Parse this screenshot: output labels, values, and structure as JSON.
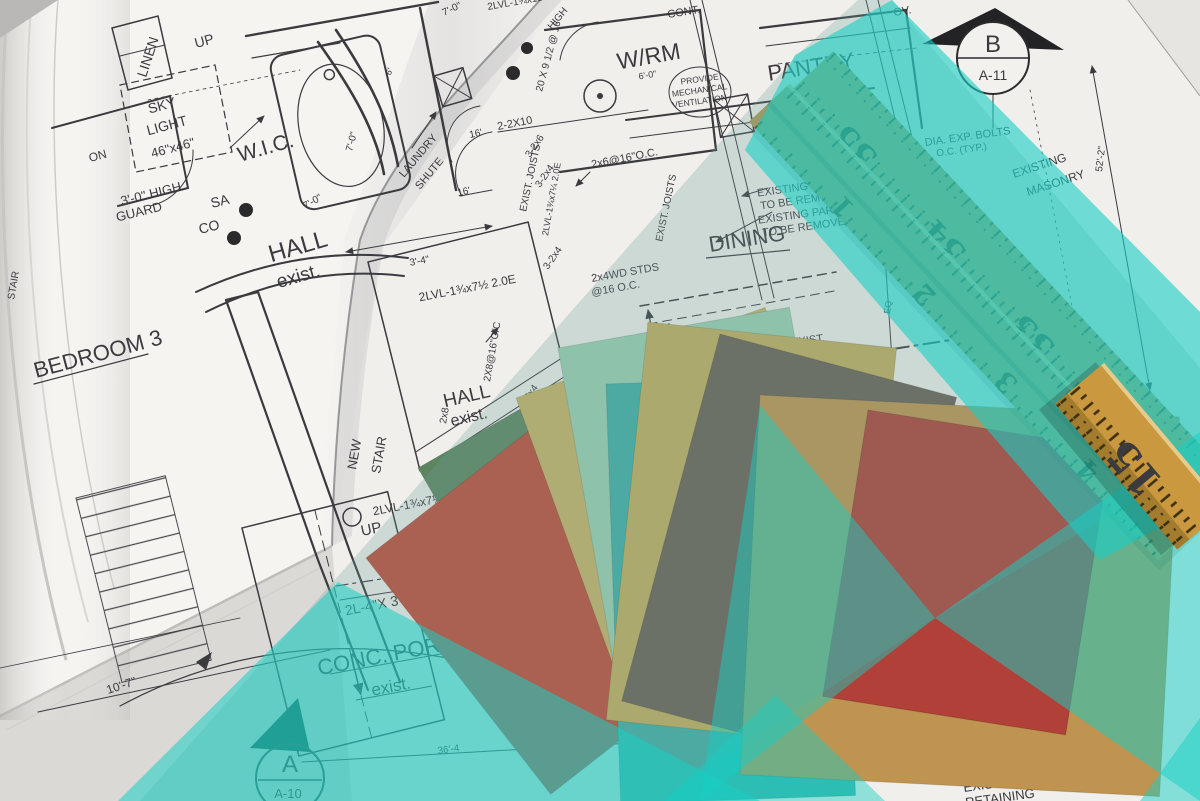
{
  "colors": {
    "paper": "#f5f4f1",
    "paper_under": "#e6e4e1",
    "paper_edge_shade": "#dbd9d6",
    "corner_dark": "#b9b8b6",
    "ink": "#3a3a3f",
    "ruler_wood": "#b2a05e",
    "ruler_wood_b": "#a99a58",
    "ruler_wood_bright": "#c9983f",
    "ruler_wood_bright_edge": "#a37c2e"
  },
  "overlay": {
    "bright": "#17cfc4",
    "wash": "#6f9e99"
  },
  "swatches": [
    {
      "name": "sage-green",
      "hex": "#5e8560"
    },
    {
      "name": "red-orange",
      "hex": "#c14b38"
    },
    {
      "name": "khaki",
      "hex": "#c9b267"
    },
    {
      "name": "seafoam",
      "hex": "#9ccfb2"
    },
    {
      "name": "teal",
      "hex": "#3fafa8"
    },
    {
      "name": "gold-khaki",
      "hex": "#c3ad5f"
    },
    {
      "name": "taupe",
      "hex": "#6a6156"
    },
    {
      "name": "camel",
      "hex": "#bf9350"
    },
    {
      "name": "red",
      "hex": "#b04038"
    }
  ],
  "ruler": {
    "upper": [
      "35",
      "34",
      "33",
      "32"
    ],
    "lower": [
      "1",
      "2",
      "3",
      "4"
    ],
    "corner": "15"
  },
  "blueprint": {
    "labels": {
      "wic": "W.I.C.",
      "linen": "LINEN",
      "up_top": "UP",
      "sky1": "SKY",
      "sky2": "LIGHT",
      "sky3": "46\"x46\"",
      "on": "ON",
      "guard1": "3'-0\" HIGH",
      "guard2": "GUARD",
      "sa": "SA",
      "co": "CO",
      "hall1": "HALL",
      "hall1b": "exist.",
      "bath_dim": "7'-0\"",
      "d70b": "7'-0\"",
      "d70c": "7'-0\"",
      "d6": "6'",
      "d16a": "16'",
      "d16b": "16'",
      "bedroom": "BEDROOM 3",
      "stair_far": "STAIR",
      "laundry_l1": "LAUNDRY",
      "laundry_l2": "SHUTE",
      "d34": "3'-4\"",
      "lvl_top": "2LVL-1¾x7½ 2.0E",
      "lvl_bot": "2LVL-1¾x7½ 2.0E",
      "up2": "UP",
      "new1": "NEW",
      "stair1": "STAIR",
      "hall2": "HALL",
      "hall2b": "exist.",
      "wrm": "W/RM",
      "d60": "6'-0\"",
      "vent1": "PROVIDE",
      "vent2": "MECHANICAL",
      "vent3": "VENTILATION",
      "pantry": "PANTRY",
      "d710": "7'-10\"",
      "laun": "LAUN.",
      "shute": "SHUTE",
      "mas1": "EXISTING MASONRY",
      "mas2": "TO BE REMOVED",
      "part1": "EXISTING PARTITION",
      "part2": "TO BE REMOVED",
      "dining": "DINING",
      "joists": "EXIST. JOISTS",
      "joists2": "EXIST. JOISTS",
      "oc": "2x6@16\"O.C.",
      "wd1": "2x4WD STDS",
      "wd2": "@16 O.C.",
      "d2210": "2-2X10",
      "d326": "3-2x6",
      "d324": "3-2x4",
      "d324b": "3-2x4",
      "d324c": "3-2x4",
      "lvlv1": "2LVL-1¾x7¼ 2.0E",
      "lvlv2": "1¾x7¼ 2.0E",
      "opening": "OPENING",
      "x2816": "2X8@16\"O/C",
      "x28": "2x8",
      "d2095": "20 X 9 1/2 @ 16",
      "high": "HIGH",
      "lvl_mid": "2LVL-1¾x11⅞ 2.0E",
      "cont": "CONT.",
      "ov": "OV.",
      "bmark": "B",
      "bsheet": "A-11",
      "bolts1": "DIA. EXP. BOLTS",
      "bolts2": "O.C. (TYP.)",
      "d522": "52'-2\"",
      "masr1": "EXISTING",
      "masr2": "MASONRY",
      "newwin": "NEW WIN",
      "d2l5": "2L-5\"",
      "eq": "EQ",
      "exist_d": "EXIST.",
      "d36": "36'",
      "d2l4": "2L-4\"X 3 1/2",
      "conc": "CONC. PORC",
      "conc2": "exist.",
      "d364": "36'-4",
      "amark": "A",
      "asheet": "A-10",
      "d107": "10'-7\"",
      "can1": "EXISTING CANOPY",
      "can2": "ABOVE",
      "ret1": "EXISTING",
      "ret2": "RETAINING"
    }
  }
}
